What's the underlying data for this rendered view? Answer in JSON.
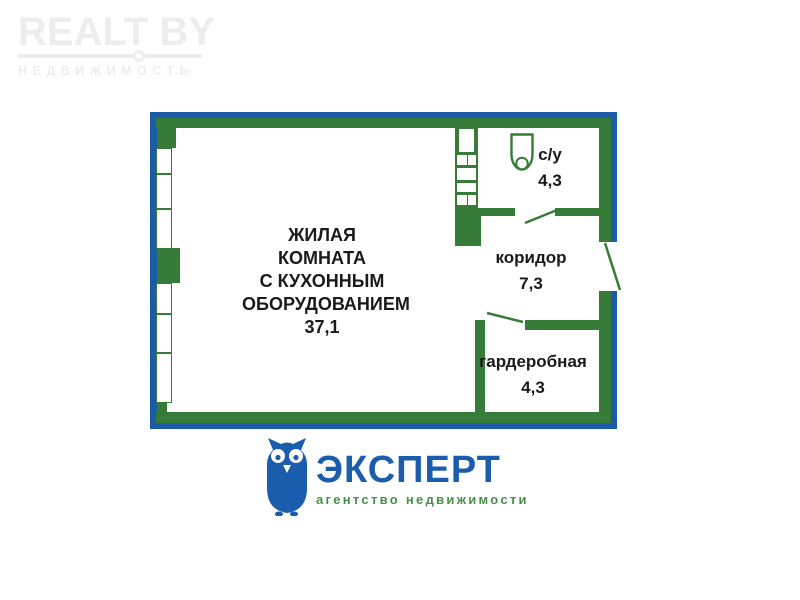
{
  "header_logo": {
    "brand": "REALT BY",
    "subtitle": "НЕДВИЖИМОСТЬ"
  },
  "floorplan": {
    "rooms": {
      "living": {
        "name_lines": [
          "ЖИЛАЯ КОМНАТА",
          "С КУХОННЫМ",
          "ОБОРУДОВАНИЕМ"
        ],
        "area": "37,1"
      },
      "bathroom": {
        "name": "с/у",
        "area": "4,3"
      },
      "corridor": {
        "name": "коридор",
        "area": "7,3"
      },
      "wardrobe": {
        "name": "гардеробная",
        "area": "4,3"
      }
    },
    "features": {
      "windows_count": 6,
      "doors_count": 3
    }
  },
  "footer_logo": {
    "name": "ЭКСПЕРТ",
    "tagline": "агентство  недвижимости"
  },
  "icons": {
    "toilet": "toilet-icon",
    "owl": "owl-icon"
  },
  "colors": {
    "frame_blue": "#1c5ca6",
    "wall_green": "#377b39",
    "brand_blue": "#1a5dad",
    "tagline_green": "#47904a",
    "logo_gray": "#ededed",
    "label_black": "#1a1a1a"
  }
}
